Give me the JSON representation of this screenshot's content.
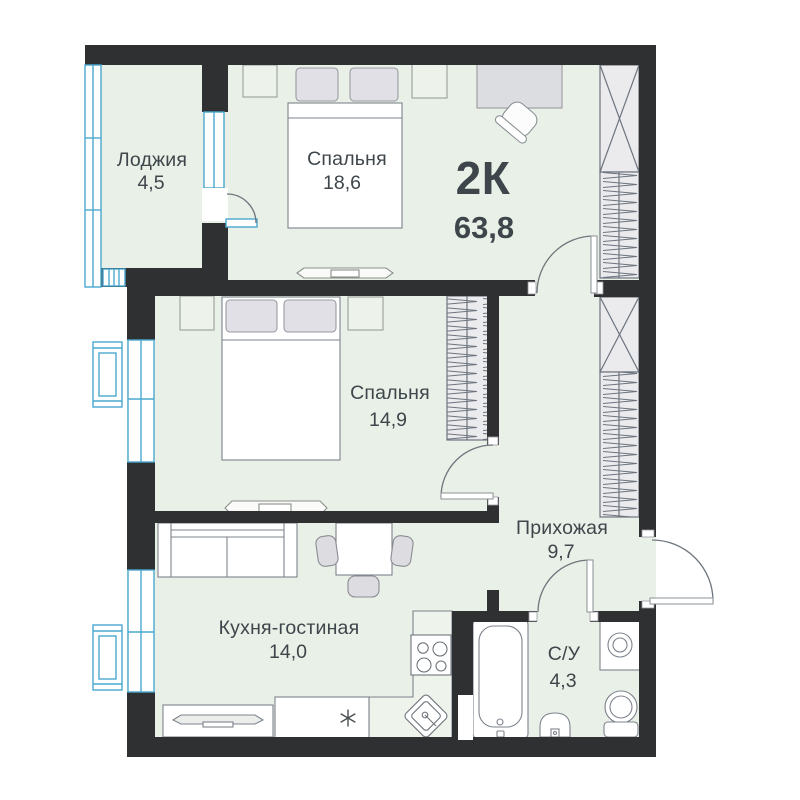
{
  "plan": {
    "type_label": "2К",
    "total_area": "63,8",
    "rooms": [
      {
        "name": "Лоджия",
        "area": "4,5"
      },
      {
        "name": "Спальня",
        "area": "18,6"
      },
      {
        "name": "Спальня",
        "area": "14,9"
      },
      {
        "name": "Прихожая",
        "area": "9,7"
      },
      {
        "name": "Кухня-гостиная",
        "area": "14,0"
      },
      {
        "name": "С/У",
        "area": "4,3"
      }
    ],
    "colors": {
      "wall": "#2e3032",
      "floor": "#e9f0e7",
      "floor_light": "#eef3ec",
      "window": "#4aa9cf",
      "text": "#3e464b",
      "furniture_stroke": "#7d838c",
      "soft_fill": "#e0e0e6",
      "soft_stroke": "#9a9aa2",
      "wardrobe_fill": "#ebebee",
      "wardrobe_stroke": "#6d747e",
      "door_arc": "#70767d"
    }
  }
}
